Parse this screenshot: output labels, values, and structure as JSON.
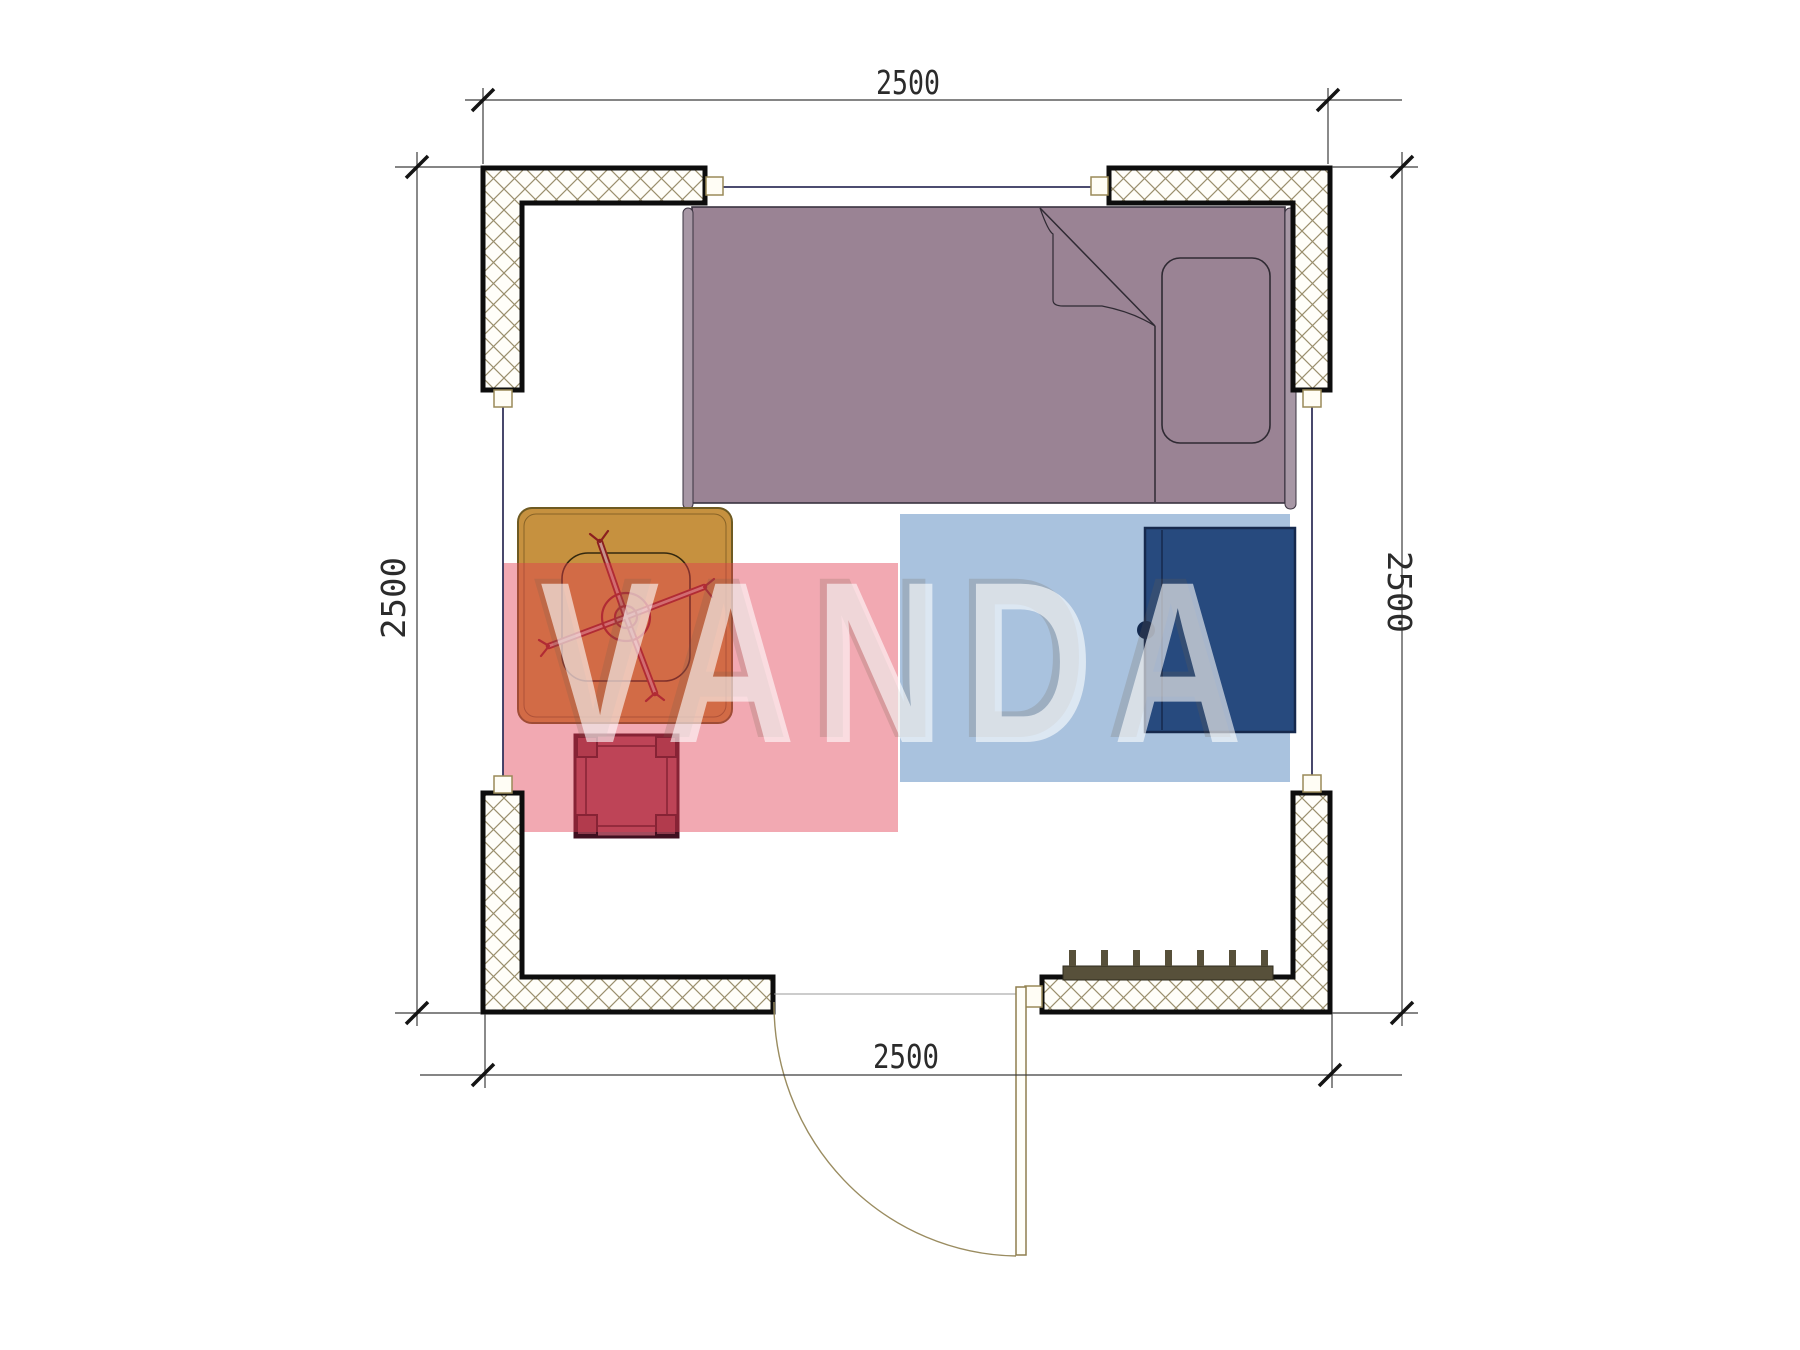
{
  "dimensions": {
    "top": "2500",
    "bottom": "2500",
    "left": "2500",
    "right": "2500"
  },
  "watermark": {
    "text": "VANDA",
    "pink_block_color": "rgba(226,60,80,0.44)",
    "blue_block_color": "rgba(99,144,195,0.55)",
    "letter_color": "rgba(255,255,255,0.60)"
  },
  "colors": {
    "bed": "#9a8394",
    "bed_rail": "#a797a5",
    "pillow": "#9a8394",
    "table": "#c6913f",
    "chair_cross": "#8b1f1f",
    "stool": "#a34b5d",
    "stool_outline": "#401020",
    "wardrobe": "#274a7e",
    "wardrobe_knob": "#13294f",
    "radiator": "#57503a",
    "wall_border": "#0d0d0d",
    "wall_hatch_line": "#9a8f6d",
    "window_line": "#33335c",
    "dimension_line": "#3c3c3c",
    "text": "#2b2b2b"
  },
  "furniture": {
    "items": [
      {
        "name": "single-bed"
      },
      {
        "name": "pillow"
      },
      {
        "name": "folded-blanket"
      },
      {
        "name": "desk-table"
      },
      {
        "name": "swivel-chair"
      },
      {
        "name": "stool"
      },
      {
        "name": "wardrobe"
      },
      {
        "name": "radiator"
      },
      {
        "name": "door"
      },
      {
        "name": "window-top"
      },
      {
        "name": "window-left"
      },
      {
        "name": "window-right"
      }
    ]
  }
}
